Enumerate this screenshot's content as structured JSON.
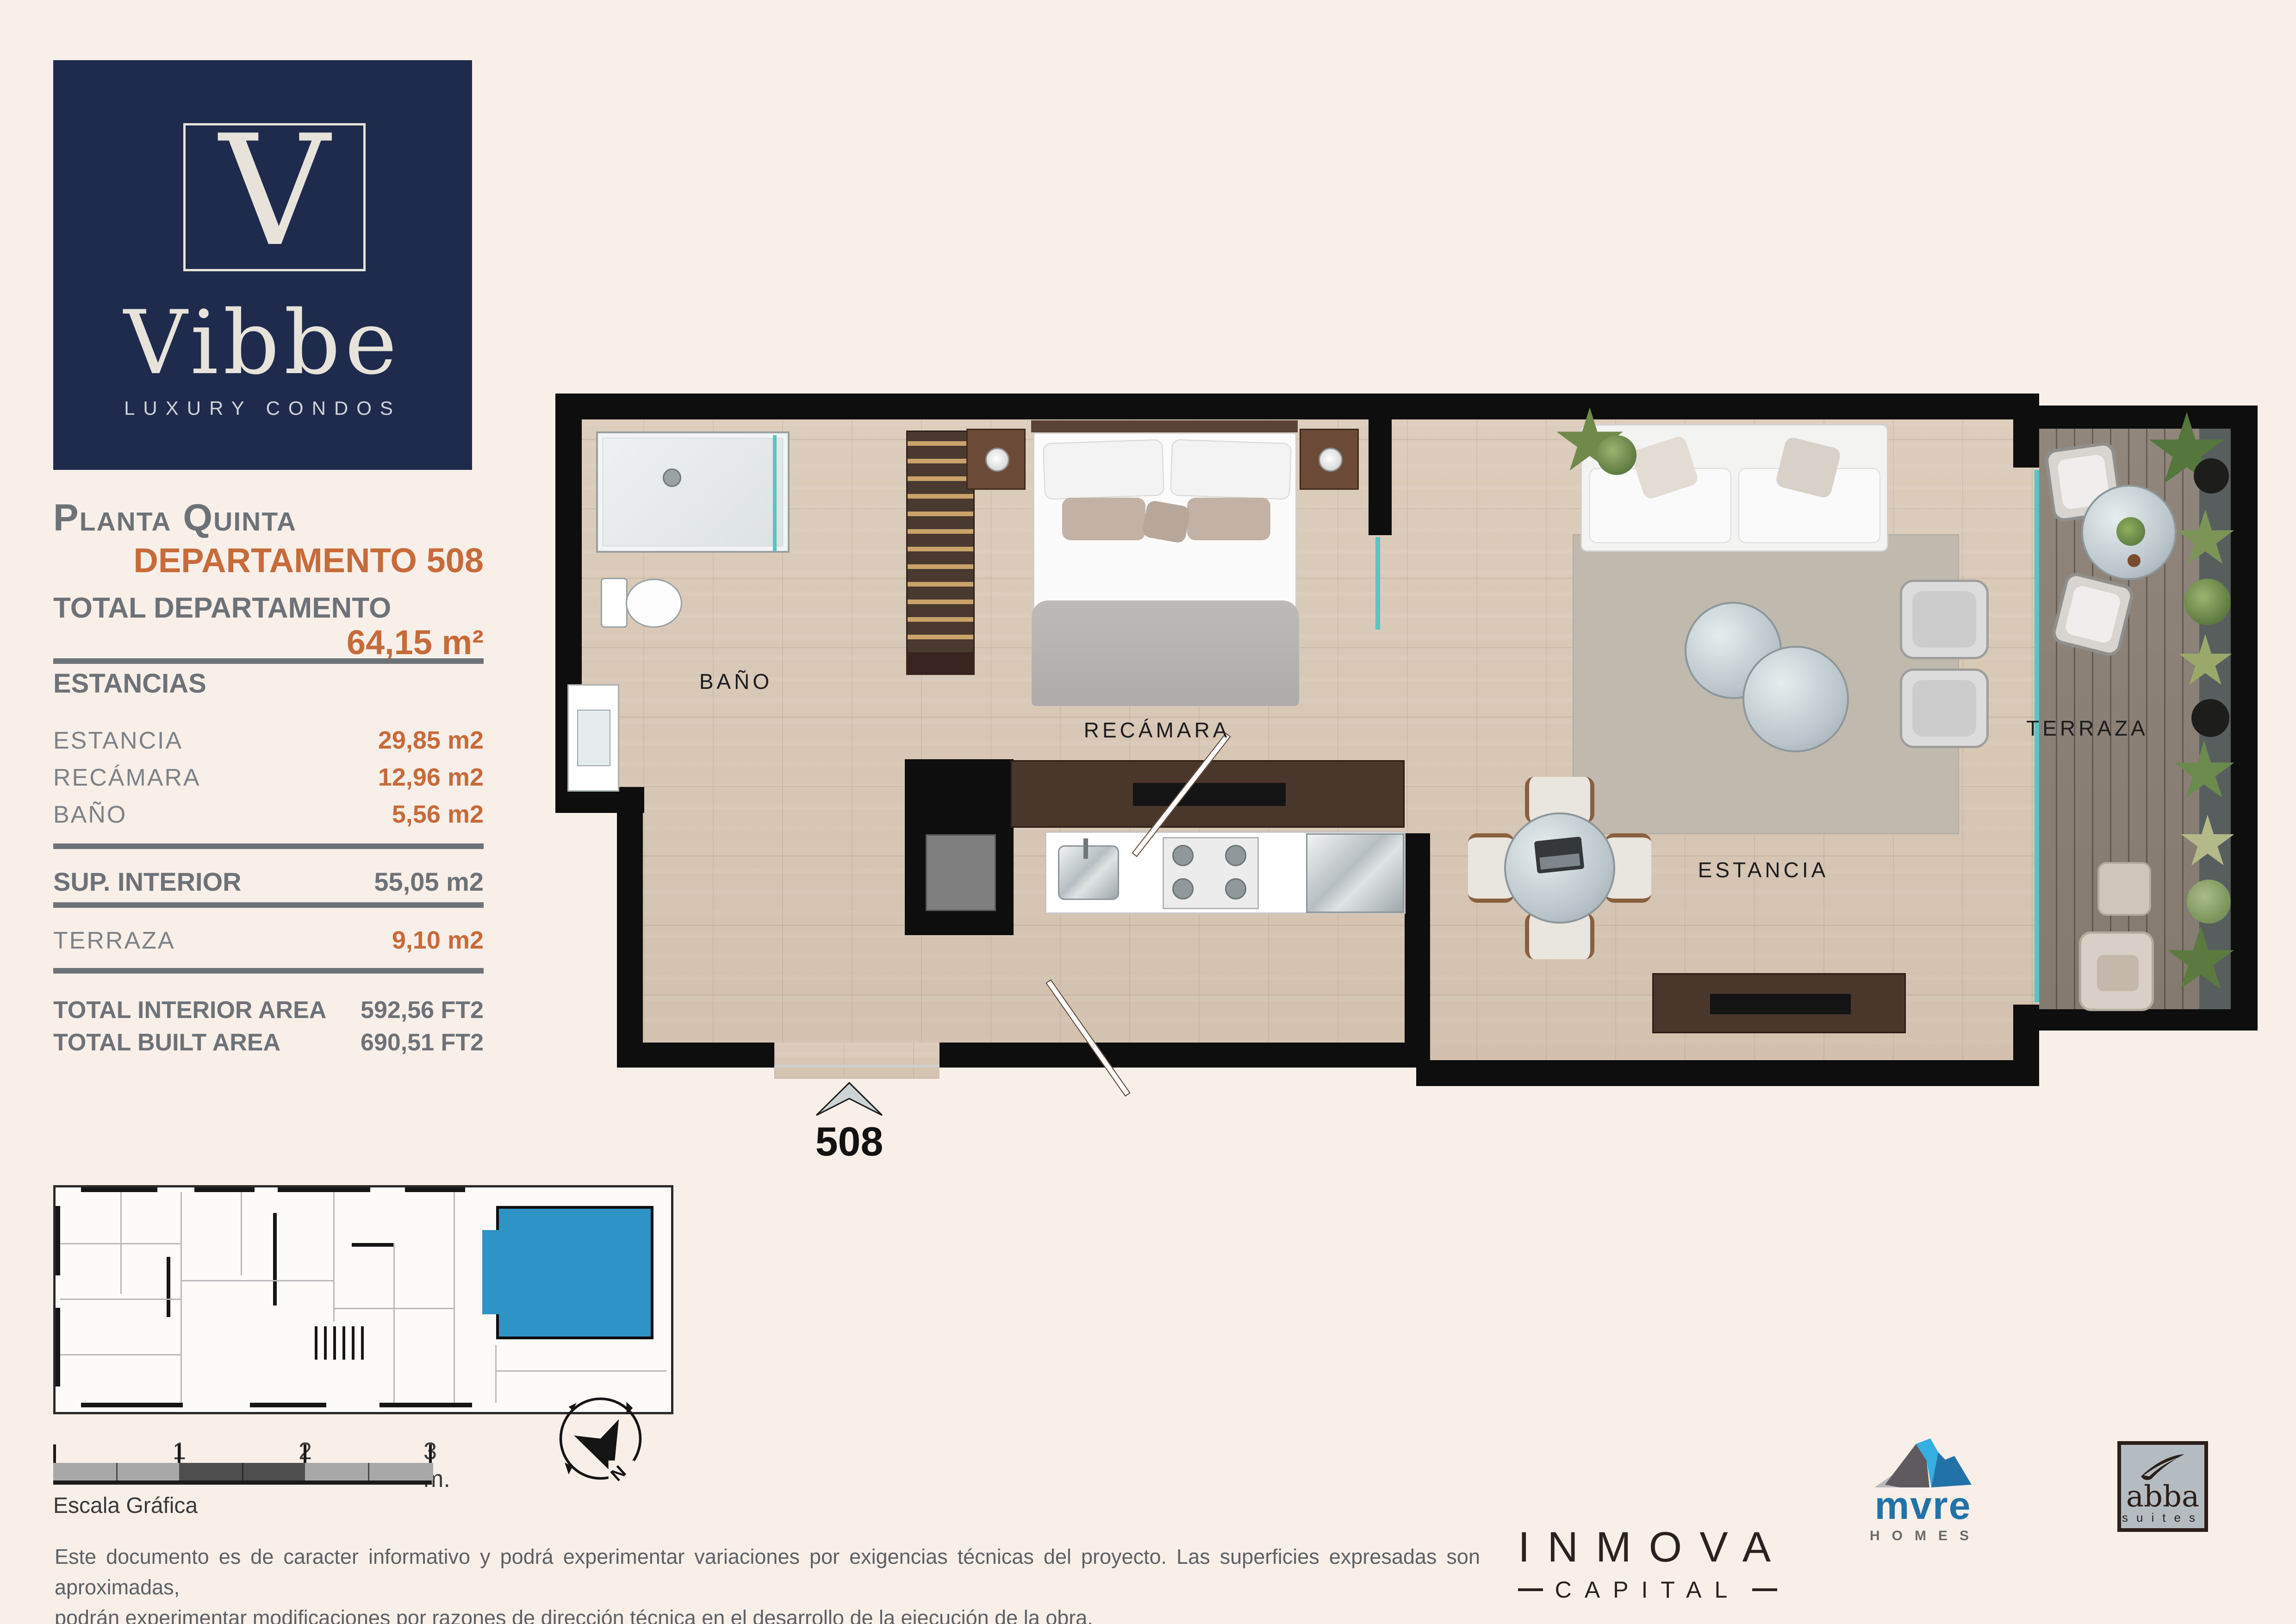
{
  "logo": {
    "letter": "V",
    "name": "Vibbe",
    "tagline": "LUXURY CONDOS"
  },
  "sidebar": {
    "floor_title": "Planta Quinta",
    "unit_title": "DEPARTAMENTO 508",
    "total_label": "TOTAL DEPARTAMENTO",
    "total_value": "64,15 m²",
    "estancias_heading": "ESTANCIAS",
    "rooms": [
      {
        "label": "ESTANCIA",
        "value": "29,85 m2"
      },
      {
        "label": "RECÁMARA",
        "value": "12,96 m2"
      },
      {
        "label": "BAÑO",
        "value": "5,56 m2"
      }
    ],
    "sup_interior_label": "SUP. INTERIOR",
    "sup_interior_value": "55,05 m2",
    "terraza_label": "TERRAZA",
    "terraza_value": "9,10 m2",
    "total_interior_label": "TOTAL INTERIOR AREA",
    "total_interior_value": "592,56 FT2",
    "total_built_label": "TOTAL BUILT AREA",
    "total_built_value": "690,51 FT2"
  },
  "plan": {
    "bath_label": "BAÑO",
    "bedroom_label": "RECÁMARA",
    "living_label": "ESTANCIA",
    "terrace_label": "TERRAZA",
    "unit_number": "508"
  },
  "scale_bar": {
    "title": "Escala Gráfica",
    "tick1": "1",
    "tick2": "2",
    "tick3": "3 m."
  },
  "compass": {
    "north": "N"
  },
  "disclaimer": {
    "line1": "Este documento es de caracter informativo y podrá experimentar variaciones por exigencias técnicas del proyecto. Las superficies expresadas son aproximadas,",
    "line2": "podrán experimentar modificaciones por razones de dirección técnica en el desarrollo de la ejecución de la obra."
  },
  "partners": {
    "inmova_name": "INMOVA",
    "inmova_sub": "CAPITAL",
    "mvre_name": "mvre",
    "mvre_sub": "HOMES",
    "abba_name": "abba",
    "abba_sub": "suites"
  },
  "colors": {
    "accent": "#C76B3A",
    "navy": "#1F2B4D",
    "gray": "#6D7278",
    "highlight_blue": "#2E93C5"
  }
}
